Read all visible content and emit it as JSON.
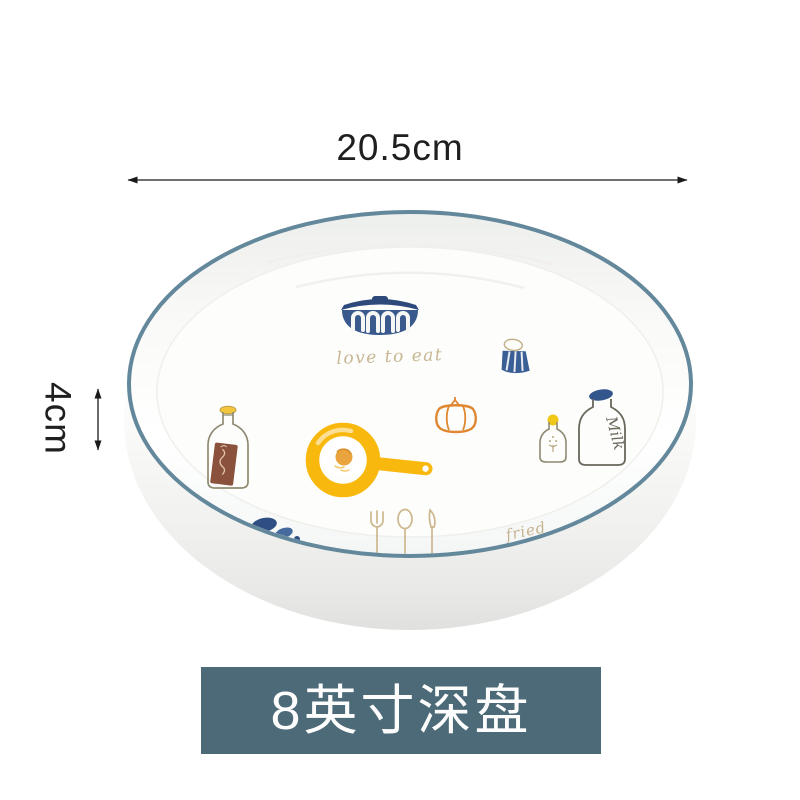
{
  "page": {
    "background": "#ffffff"
  },
  "annotations": {
    "width": {
      "label": "20.5cm"
    },
    "height": {
      "label": "4cm"
    },
    "arrow_color": "#1a1a1a",
    "text_color": "#1f1f1f"
  },
  "product_label": {
    "text": "8英寸深盘",
    "background": "#4d6a78",
    "color": "#fdfdfd"
  },
  "plate": {
    "description": "white ceramic 8-inch deep plate, blue rim, kitchen doodle artwork",
    "rim_color": "#64889b",
    "body_color": "#fbfbfa",
    "wall_shade_color": "#e2e3e0",
    "artwork": {
      "script_center": "love to eat",
      "script_bottom_right": "fried",
      "milk_bottle_label": "Milk",
      "palette": {
        "navy": "#3a5a8e",
        "navy_dark": "#2d4a7b",
        "yellow": "#f8b80e",
        "orange": "#df8732",
        "tan_script": "#c6b28d",
        "brown_label": "#8a523c",
        "bottle_outline": "#8f8a72"
      },
      "icons": [
        "casserole-pot-icon",
        "salt-shaker-icon",
        "tomato-icon",
        "frying-pan-egg-icon",
        "sauce-bottle-icon",
        "seasoning-bottle-icon",
        "milk-bottle-icon",
        "fork-icon",
        "spoon-icon",
        "knife-icon",
        "blue-splash-icon"
      ]
    }
  }
}
